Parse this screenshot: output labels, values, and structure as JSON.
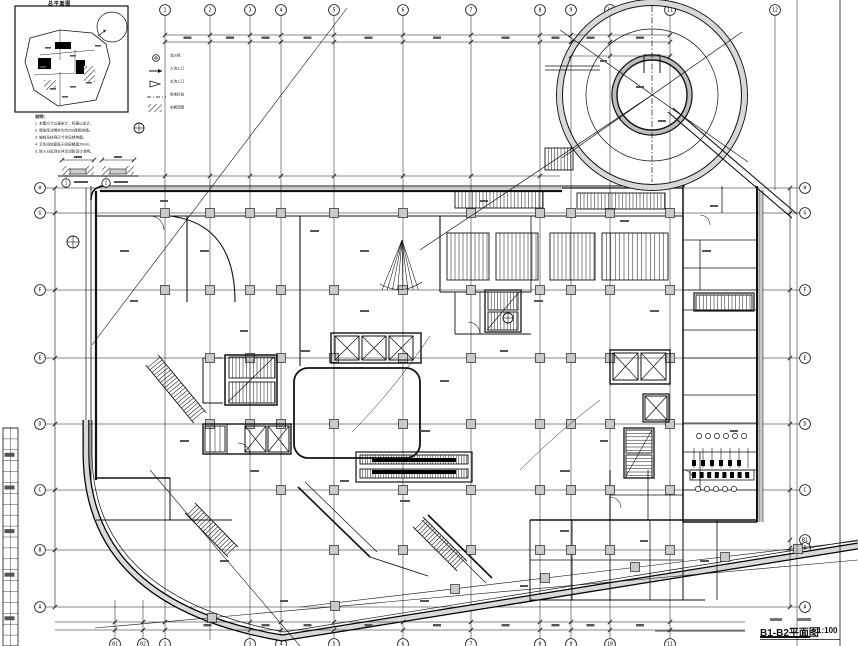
{
  "sheet": {
    "title": "B1-B2平面图",
    "scale": "1:100"
  },
  "inset": {
    "title": "总平面图"
  },
  "legend": {
    "items": [
      {
        "glyph": "hydrant-icon",
        "label": "消火栓"
      },
      {
        "glyph": "arrow-icon",
        "label": "人流入口"
      },
      {
        "glyph": "triangle-icon",
        "label": "车流入口"
      },
      {
        "glyph": "boundary-icon",
        "label": "用地红线"
      },
      {
        "glyph": "hatch-icon",
        "label": "本期范围"
      }
    ]
  },
  "notes": {
    "heading": "说明：",
    "lines": [
      "1. 本图尺寸以毫米计，标高以米计。",
      "2. 墙体除注明外均为200厚砌块墙。",
      "3. 轴线及柱网尺寸详见结构图。",
      "4. 卫生间地面低于同层楼面20mm。",
      "5. 防火分区划分详见消防设计说明。"
    ]
  },
  "details": {
    "items": [
      {
        "number": "1"
      },
      {
        "number": "2"
      }
    ]
  },
  "grid": {
    "top_labels": [
      "1",
      "2",
      "3",
      "4",
      "5",
      "6",
      "7",
      "8",
      "9",
      "10",
      "11",
      "12"
    ],
    "bottom_labels": [
      "01",
      "02",
      "1",
      "3",
      "4",
      "5",
      "6",
      "7",
      "8",
      "9",
      "10",
      "11"
    ],
    "left_labels": [
      "H",
      "G",
      "F",
      "E",
      "D",
      "C",
      "B",
      "A"
    ],
    "right_labels": [
      "H",
      "G",
      "F",
      "E",
      "D",
      "C",
      "B1",
      "B",
      "A"
    ]
  }
}
